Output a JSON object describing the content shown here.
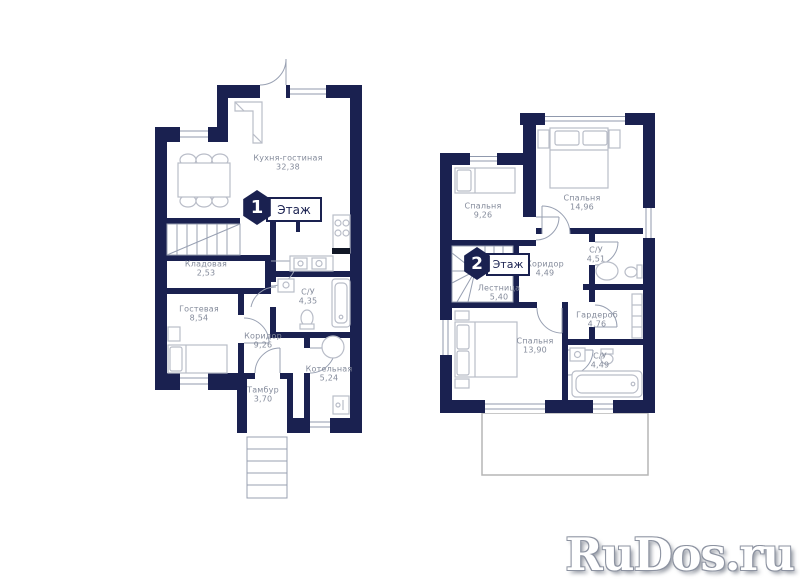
{
  "watermark": "RuDos.ru",
  "floor1": {
    "badge": {
      "number": "1",
      "label": "Этаж"
    },
    "rooms": {
      "kitchen_living": {
        "name": "Кухня-гостиная",
        "area": "32,38"
      },
      "storage": {
        "name": "Кладовая",
        "area": "2,53"
      },
      "guest": {
        "name": "Гостевая",
        "area": "8,54"
      },
      "bathroom": {
        "name": "С/У",
        "area": "4,35"
      },
      "corridor": {
        "name": "Коридор",
        "area": "9,26"
      },
      "vestibule": {
        "name": "Тамбур",
        "area": "3,70"
      },
      "boiler": {
        "name": "Котельная",
        "area": "5,24"
      }
    }
  },
  "floor2": {
    "badge": {
      "number": "2",
      "label": "Этаж"
    },
    "rooms": {
      "bedroom_small": {
        "name": "Спальня",
        "area": "9,26"
      },
      "bedroom_large": {
        "name": "Спальня",
        "area": "14,96"
      },
      "bathroom_top": {
        "name": "С/У",
        "area": "4,51"
      },
      "corridor": {
        "name": "Коридор",
        "area": "4,49"
      },
      "stairs": {
        "name": "Лестница",
        "area": "5,40"
      },
      "bedroom_bottom": {
        "name": "Спальня",
        "area": "13,90"
      },
      "wardrobe": {
        "name": "Гардероб",
        "area": "4,76"
      },
      "bathroom_bottom": {
        "name": "С/У",
        "area": "4,49"
      }
    }
  },
  "colors": {
    "wall": "#1a2150",
    "label_text": "#848b9b",
    "thin_line": "#98a0b2",
    "furniture_line": "#b9bdc8",
    "terrace_outline": "#b5b5b5"
  }
}
